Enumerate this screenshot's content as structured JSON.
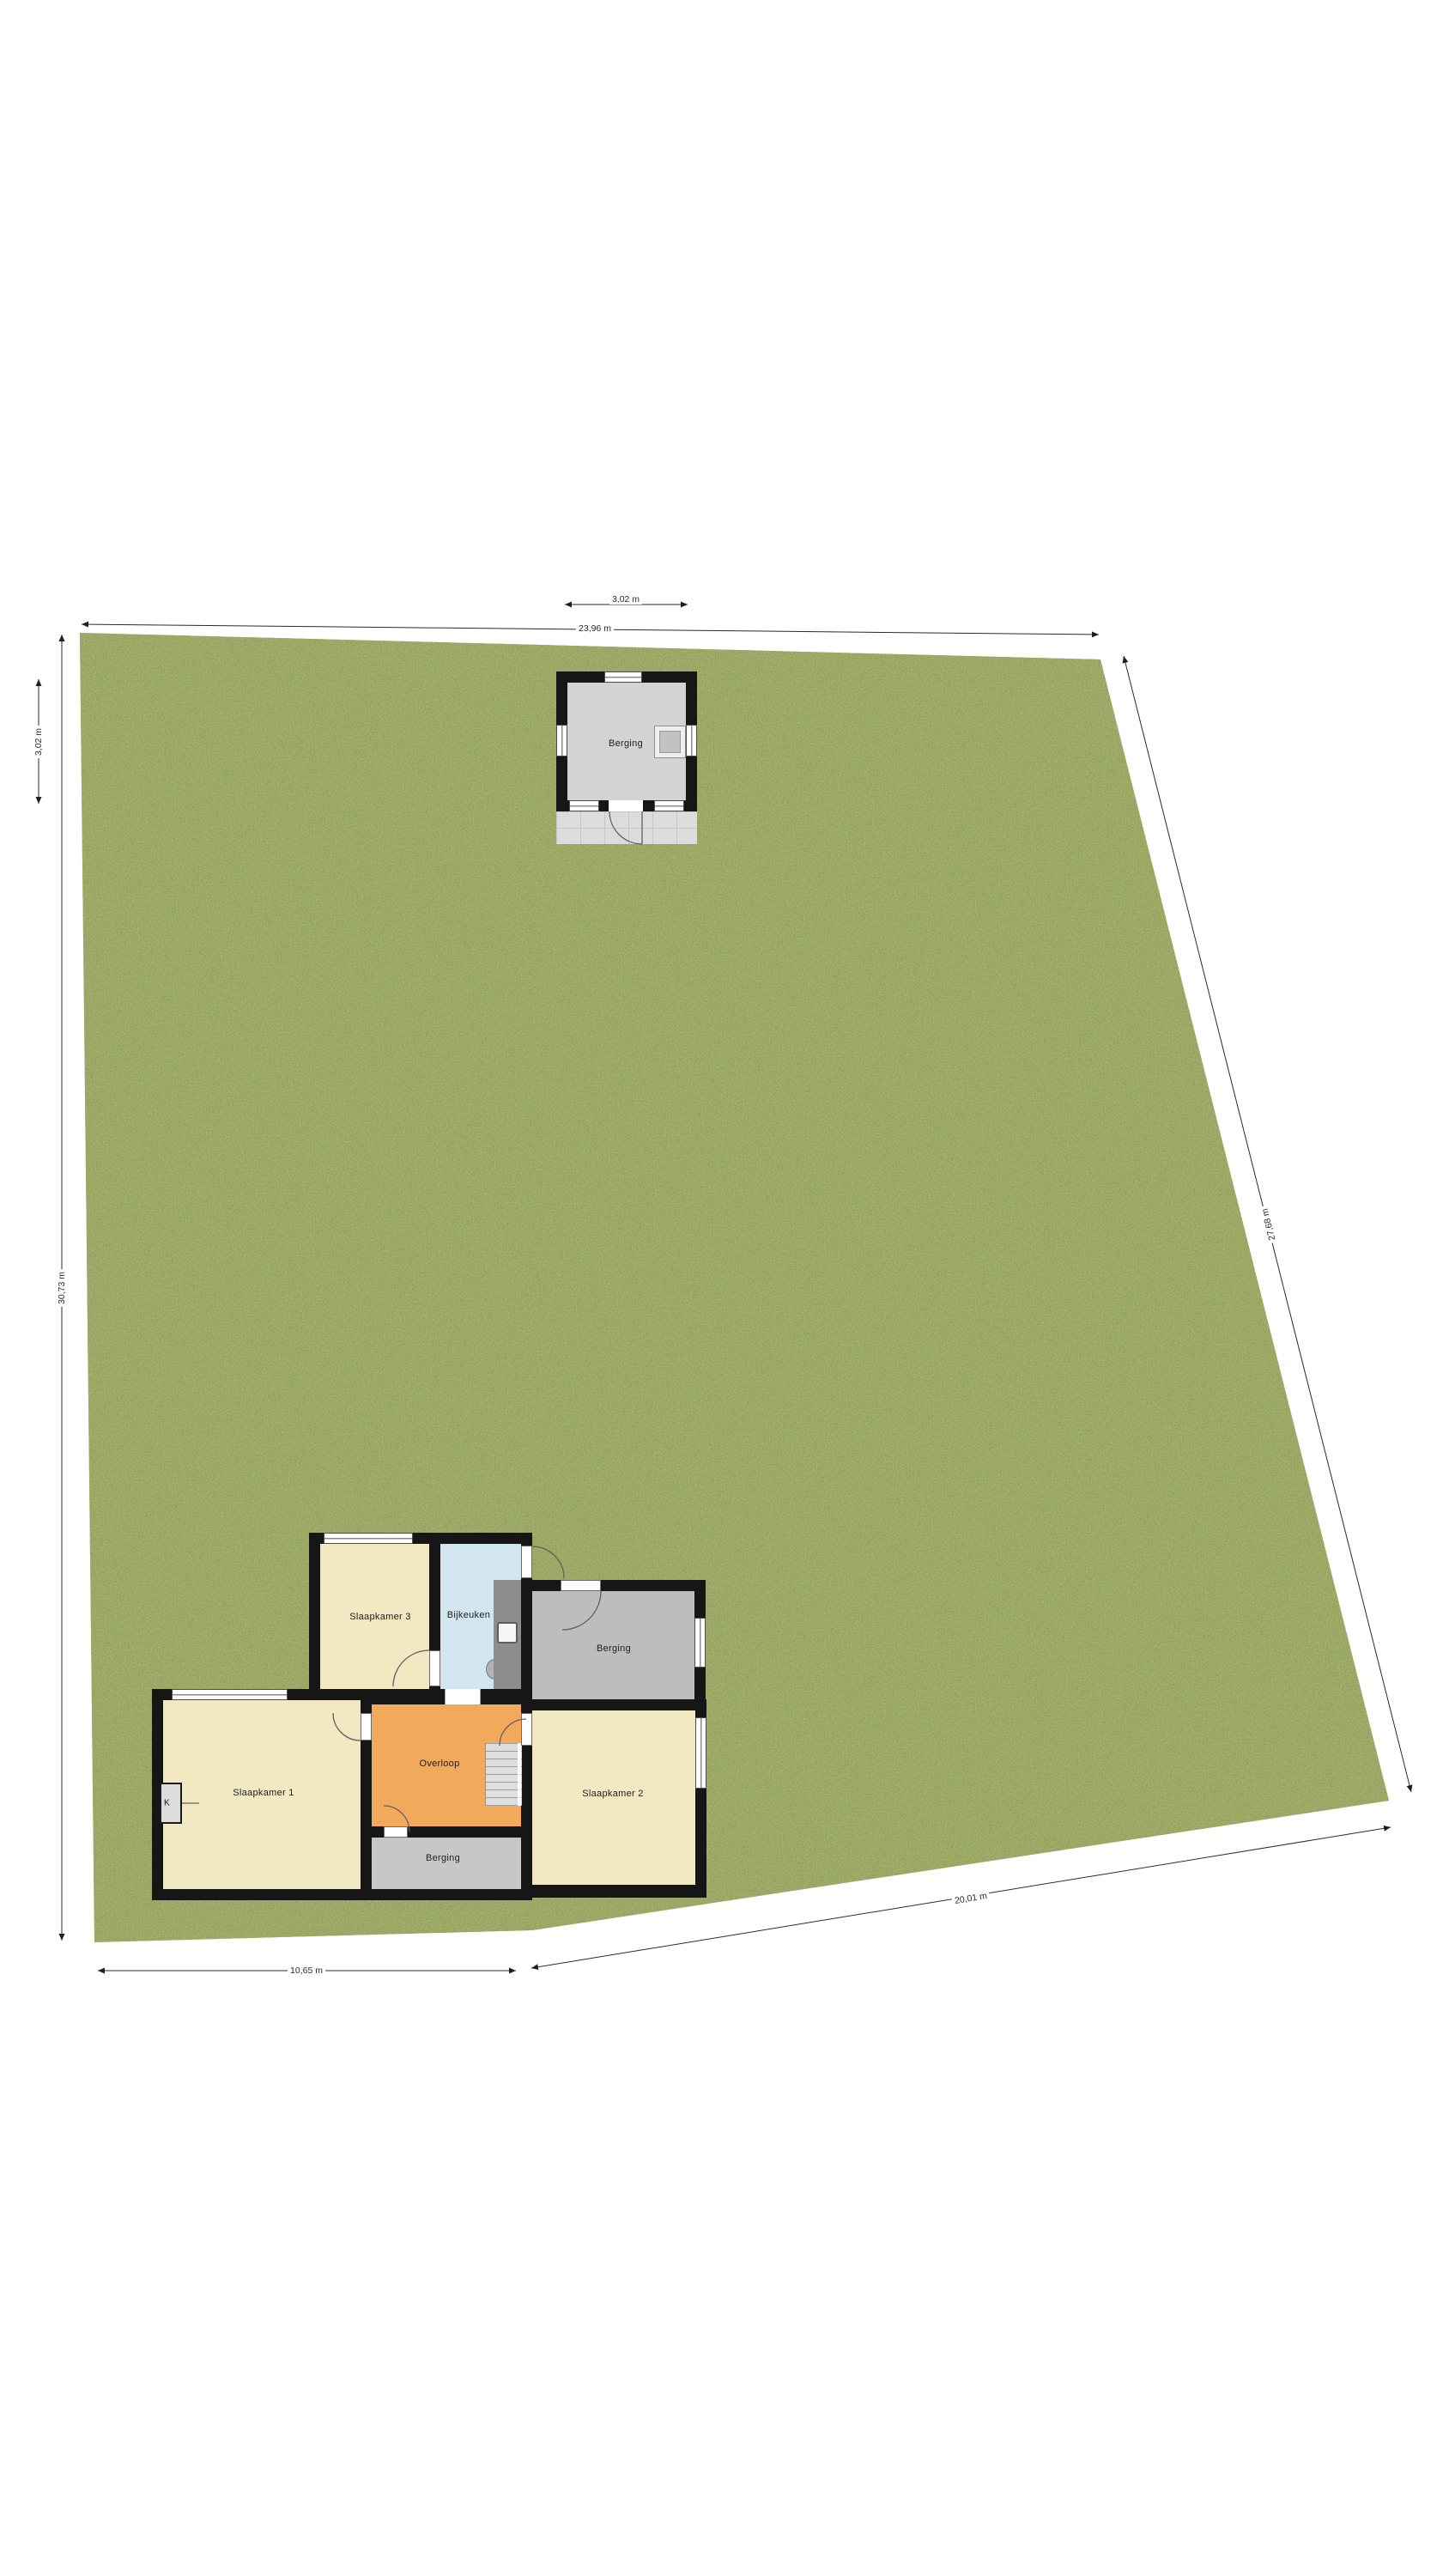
{
  "floorplan": {
    "garden": {
      "shed": {
        "name": "Berging"
      },
      "dimensions": {
        "shed_width": "3,02 m",
        "shed_depth": "3,02 m",
        "plot_top": "23,96 m",
        "plot_left": "30,73 m",
        "plot_right": "27,68 m",
        "plot_bottom_right": "20,01 m",
        "plot_bottom_left": "10,65 m"
      }
    },
    "house": {
      "rooms": {
        "slaapkamer3": "Slaapkamer 3",
        "bijkeuken": "Bijkeuken",
        "berging_upper": "Berging",
        "slaapkamer1": "Slaapkamer 1",
        "overloop": "Overloop",
        "slaapkamer2": "Slaapkamer 2",
        "berging_lower": "Berging",
        "k_shaft": "K"
      }
    },
    "colors": {
      "grass": "#7c8f43",
      "wall": "#161616",
      "room_cream": "#f2e9c3",
      "room_orange": "#f3a95c",
      "room_blue": "#d2e6f0",
      "room_gray": "#c7c7c7",
      "shed_floor": "#d3d3d3",
      "patio": "#dcdcdc"
    }
  }
}
